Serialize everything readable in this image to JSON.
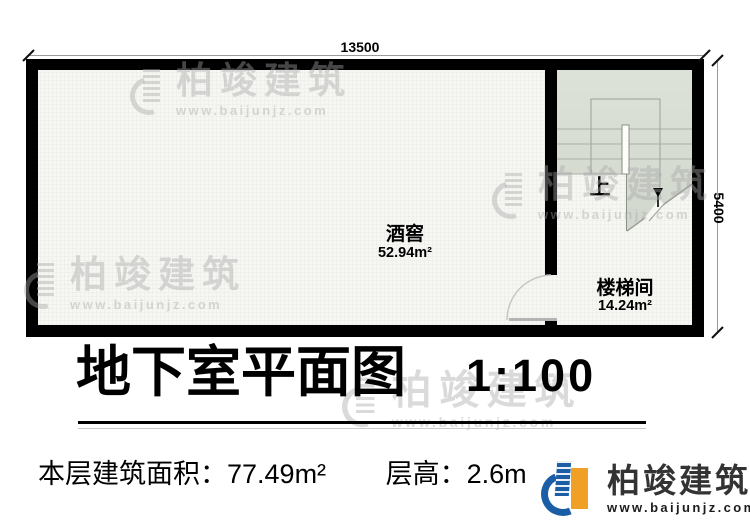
{
  "plan": {
    "dim_top": "13500",
    "dim_right": "5400",
    "stair_up": "上",
    "rooms": [
      {
        "name": "酒窖",
        "area": "52.94m²"
      },
      {
        "name": "楼梯间",
        "area": "14.24m²"
      }
    ]
  },
  "title": {
    "text": "地下室平面图",
    "scale": "1:100"
  },
  "info": {
    "area": "本层建筑面积：77.49m²",
    "height": "层高：2.6m"
  },
  "logo": {
    "brand": "柏竣建筑",
    "url": "www.baijunjz.com"
  },
  "watermark": {
    "brand": "柏竣建筑",
    "url": "www.baijunjz.com"
  },
  "colors": {
    "wall": "#000000",
    "stair_fill": "#d8ddd3",
    "logo_blue": "#1b5ea6",
    "logo_orange": "#f0a125"
  }
}
